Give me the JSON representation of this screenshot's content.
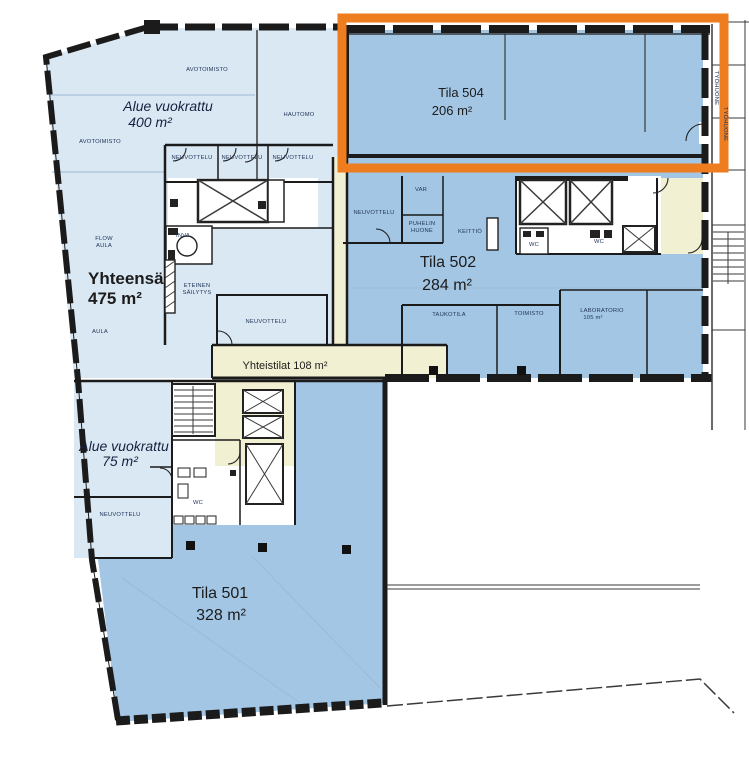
{
  "plan": {
    "colors": {
      "light_blue": "#dae8f4",
      "medium_blue": "#a3c6e4",
      "pale_yellow": "#f2f0d2",
      "wall_black": "#1b1b1b",
      "highlight_orange": "#ee7d1f"
    },
    "highlight": {
      "color": "#ee7d1f"
    },
    "spaces": {
      "tila504": {
        "name": "Tila 504",
        "area": "206 m²"
      },
      "tila502": {
        "name": "Tila 502",
        "area": "284 m²"
      },
      "tila501": {
        "name": "Tila 501",
        "area": "328 m²"
      },
      "alue400": {
        "name": "Alue vuokrattu",
        "area": "400 m²"
      },
      "alue75": {
        "name": "Alue vuokrattu",
        "area": "75 m²"
      },
      "yhteensa": {
        "name": "Yhteensä",
        "area": "475 m²"
      },
      "yhteistilat": {
        "name": "Yhteistilat 108 m²"
      }
    },
    "rooms": [
      {
        "text": "AVOTOIMISTO"
      },
      {
        "text": "AVOTOIMISTO"
      },
      {
        "text": "HAUTOMO"
      },
      {
        "text": "NEUVOTTELU"
      },
      {
        "text": "NEUVOTTELU"
      },
      {
        "text": "NEUVOTTELU"
      },
      {
        "text": "INVA"
      },
      {
        "text": "ETEINEN"
      },
      {
        "text": "SÄILYTYS"
      },
      {
        "text": "NEUVOTTELU"
      },
      {
        "text": "FLOW"
      },
      {
        "text": "AULA"
      },
      {
        "text": "AULA"
      },
      {
        "text": "NEUVOTTELU"
      },
      {
        "text": "VAR"
      },
      {
        "text": "PUHELIN"
      },
      {
        "text": "HUONE"
      },
      {
        "text": "KEITTIÖ"
      },
      {
        "text": "WC"
      },
      {
        "text": "WC"
      },
      {
        "text": "TAUKOTILA"
      },
      {
        "text": "TOIMISTO"
      },
      {
        "text": "LABORATORIO"
      },
      {
        "text": "105 m²"
      },
      {
        "text": "NEUVOTTELU"
      },
      {
        "text": "WC"
      },
      {
        "text": "TYÖHUONE"
      },
      {
        "text": "TYÖHUONE"
      }
    ]
  }
}
